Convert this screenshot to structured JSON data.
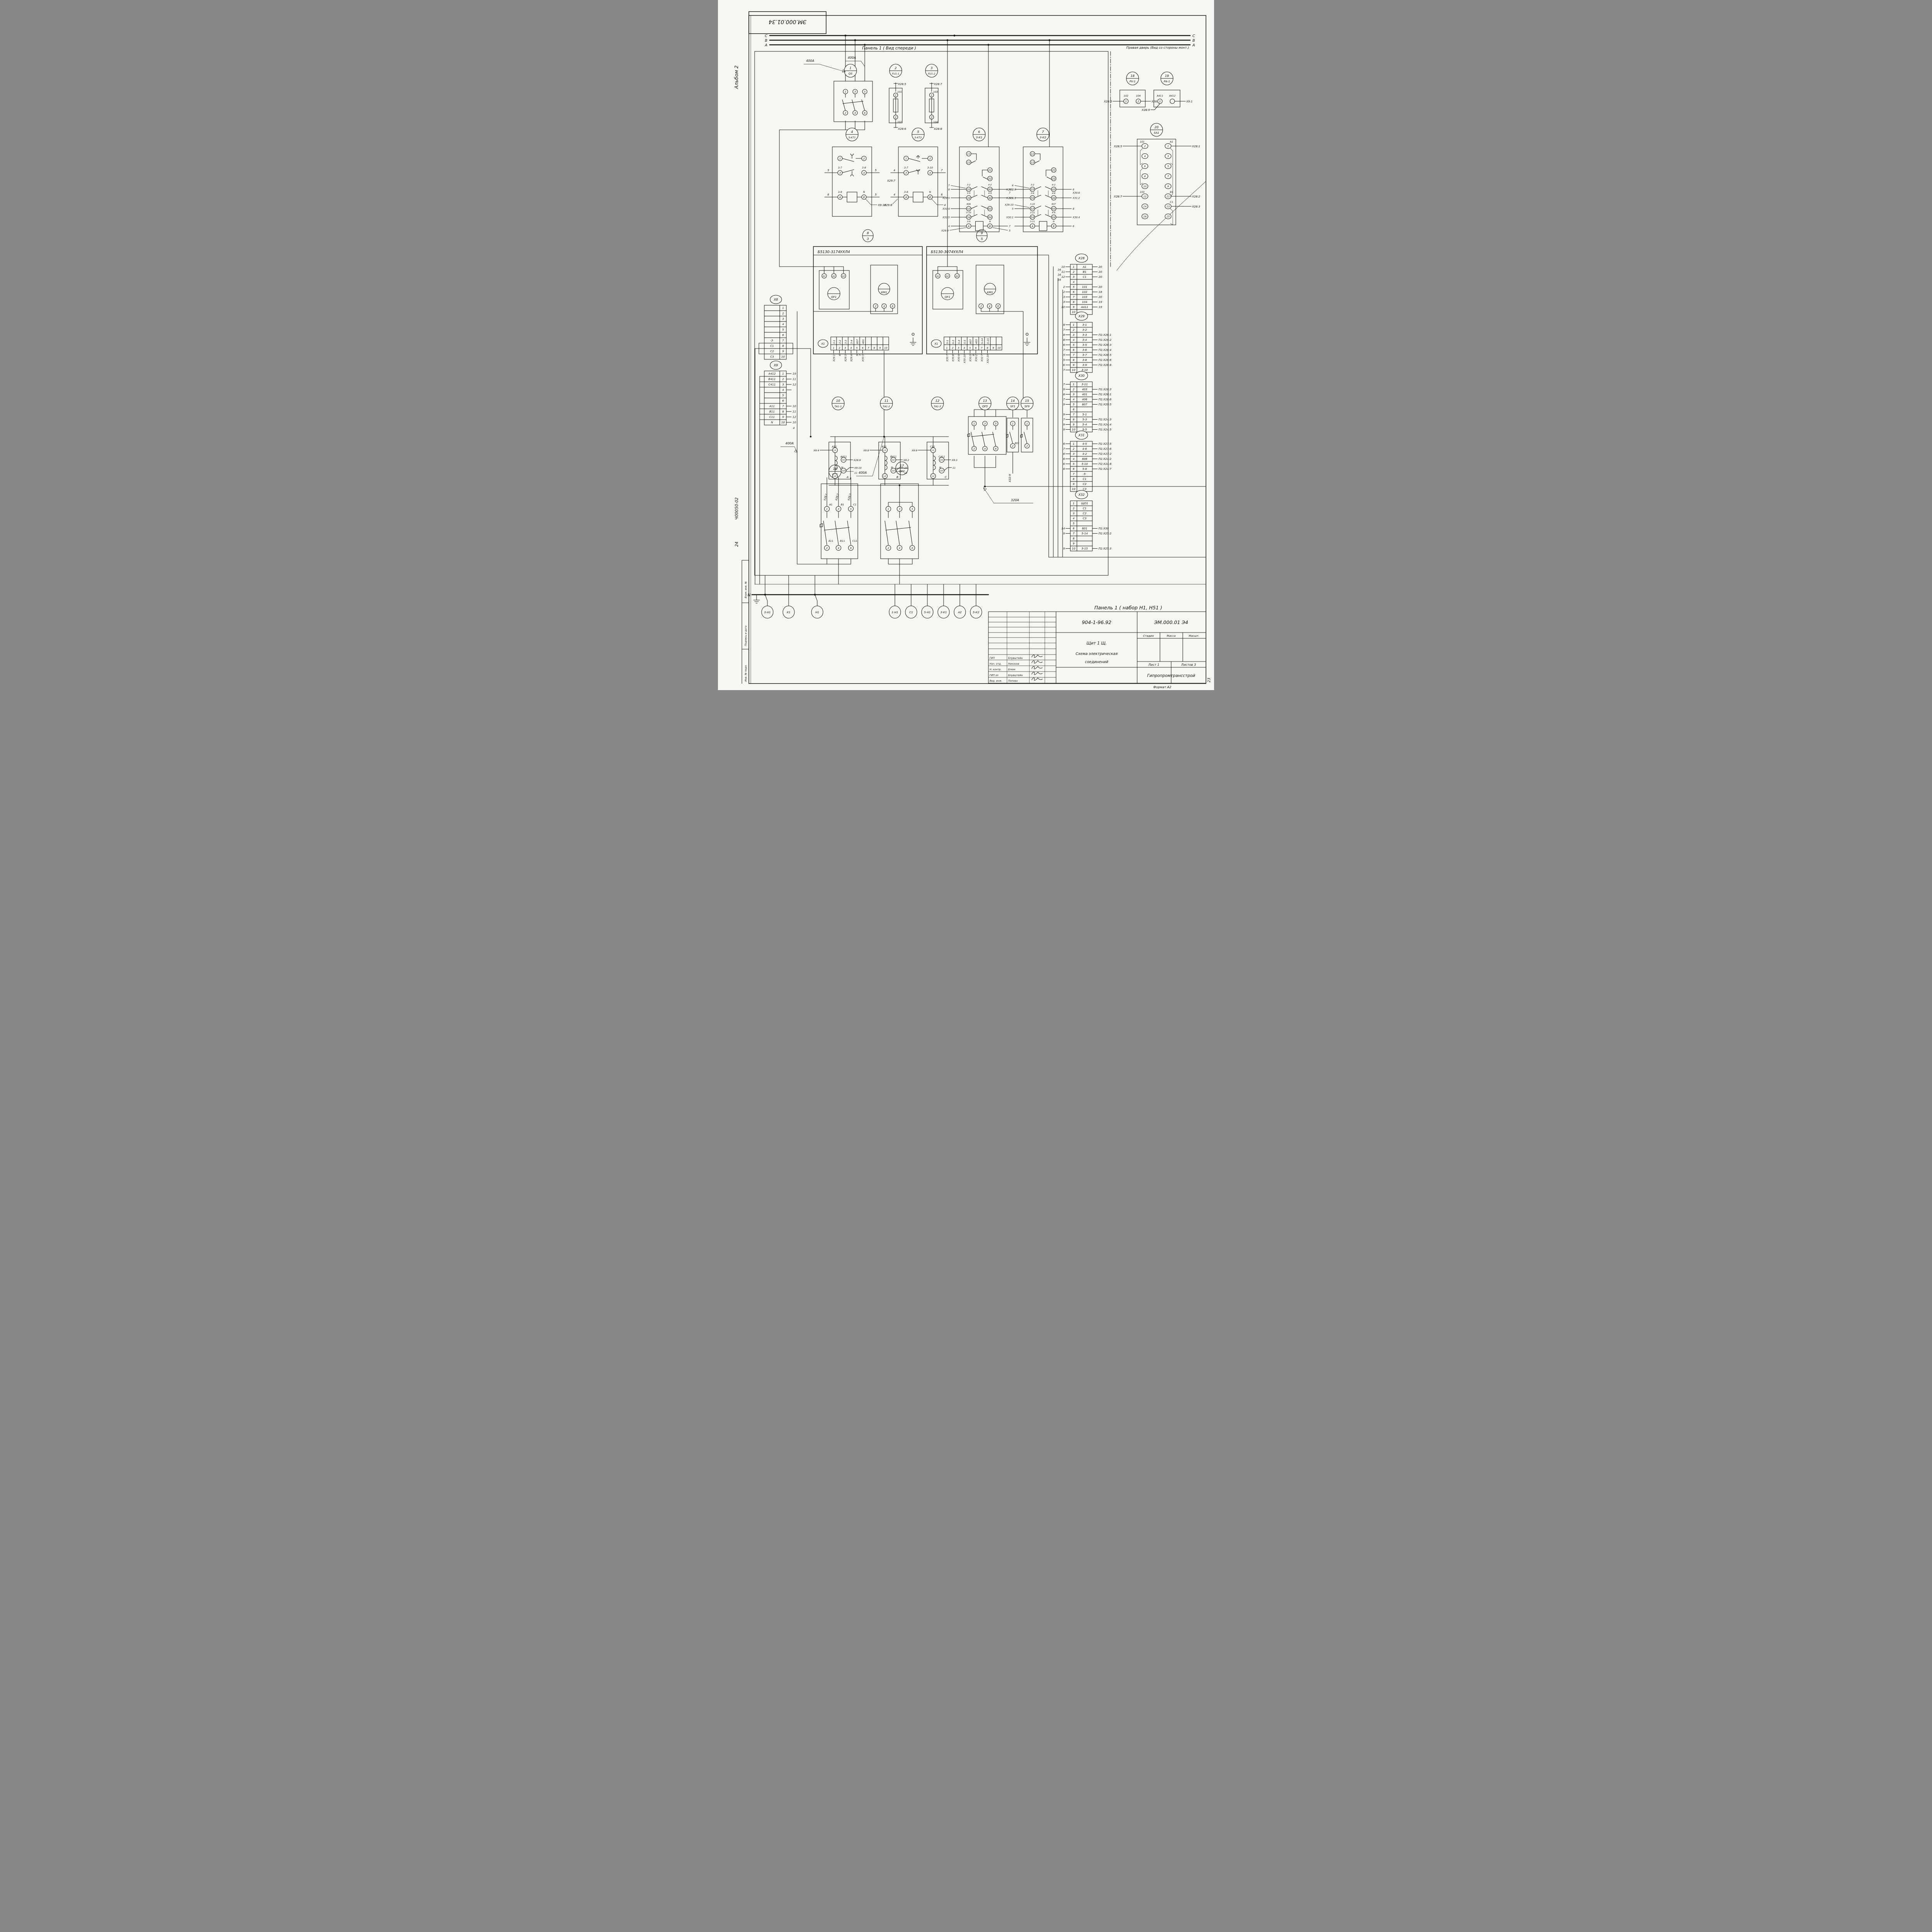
{
  "frame": {
    "stamp": "ЭМ.000.01.34",
    "album": "Альбом 2",
    "page": "23",
    "format": "Формат А2",
    "margin1": "Взам. инв. №",
    "margin2": "Подпись и дата",
    "margin3": "Инв. № подл.",
    "hand1": "Ч00050-02",
    "hand2": "24"
  },
  "buses": {
    "c": "С",
    "b": "В",
    "a": "А",
    "n": "N"
  },
  "titles": {
    "panel_front": "Панель 1 ( Вид спереди )",
    "right_door": "Правая дверь (Вид со стороны монт.)",
    "panel_set": "Панель 1  ( набор  Н1, Н51 )"
  },
  "labels": {
    "amp400": "400А",
    "amp320": "320А",
    "x9extra": "4"
  },
  "devices": {
    "d1": {
      "num": "1",
      "name": "QS",
      "t": [
        "1",
        "3",
        "5",
        "2",
        "4",
        "6"
      ]
    },
    "d2": {
      "num": "2",
      "name": "FU1-1",
      "top": "Х28:5",
      "w1": "101",
      "t1": "1",
      "t2": "2",
      "w2": "102",
      "bot": "Х28:6"
    },
    "d3": {
      "num": "3",
      "name": "FU1-2",
      "top": "Х28:7",
      "w1": "103",
      "t1": "1",
      "t2": "2",
      "w2": "104",
      "bot": "Х28:8"
    },
    "d4": {
      "num": "4",
      "name": "3-КТ1",
      "t1": "1",
      "t2": "2",
      "w3": "3-7",
      "w4": "3-8",
      "t3": "3",
      "t4": "4",
      "l3": "5",
      "r4": "5",
      "wa": "3-9",
      "wb": "N",
      "ta": "А",
      "tb": "В",
      "la": "6",
      "rb": "5",
      "anno": "Х9:10"
    },
    "d5": {
      "num": "5",
      "name": "3-КТ2",
      "t1": "1",
      "t2": "2",
      "w3": "3-7",
      "w4": "3-10",
      "t3": "3",
      "t4": "4",
      "l3": "4",
      "l3b": "Х29:7",
      "r4": "7",
      "wa": "3-8",
      "wb": "N",
      "ta": "А",
      "tb": "В",
      "la": "4",
      "lab": "Х29:8",
      "rb": "6",
      "anno": "4"
    },
    "d6": {
      "num": "6",
      "name": "3-К1",
      "t11": "11",
      "t12": "12",
      "t21": "21",
      "t22": "22",
      "rows": [
        {
          "lt": "33",
          "lw": "3-2",
          "la": "8",
          "lb": "7",
          "rt": "43",
          "rw": "4-2",
          "ra": "Х31:3",
          "rb": "7"
        },
        {
          "lt": "34",
          "lw": "3-5",
          "la": "Х29:5",
          "lb": "",
          "rt": "44",
          "rw": "4-5",
          "ra": "Х31:1",
          "rb": ""
        },
        {
          "lt": "53",
          "lw": "806",
          "la": "Х31:4",
          "lb": "",
          "rt": "63",
          "rw": "",
          "ra": "",
          "rb": ""
        },
        {
          "lt": "54",
          "lw": "5-10",
          "la": "Х31:5",
          "lb": "",
          "rt": "64",
          "rw": "",
          "ra": "",
          "rb": ""
        }
      ],
      "caw": "3-9",
      "ca": "А",
      "cal": "4",
      "cal2": "Х29:9",
      "cbw": "N",
      "cb": "В",
      "cbr": "7",
      "cbr2": "5"
    },
    "d7": {
      "num": "7",
      "name": "3-К2",
      "t11": "11",
      "t12": "12",
      "t21": "21",
      "t22": "22",
      "rows": [
        {
          "lt": "33",
          "lw": "3-2",
          "la": "Х29:2",
          "lb": "6",
          "rt": "43",
          "rw": "4-2",
          "ra": "6",
          "rb": "Х30:8"
        },
        {
          "lt": "34",
          "lw": "3-6",
          "la": "Х29:6",
          "lb": "",
          "rt": "44",
          "rw": "4-6",
          "ra": "Х31:2",
          "rb": ""
        },
        {
          "lt": "53",
          "lw": "3-10",
          "la": "5",
          "lb": "Х29:10",
          "rt": "63",
          "rw": "807",
          "ra": "8",
          "rb": ""
        },
        {
          "lt": "54",
          "lw": "3-11",
          "la": "Х30:1",
          "lb": "",
          "rt": "64",
          "rw": "4-6",
          "ra": "Х30:4",
          "rb": ""
        }
      ],
      "caw": "3-11",
      "ca": "А",
      "cal": "",
      "cal2": "",
      "cbw": "N",
      "cb": "В",
      "cbr": "6",
      "cbr2": ""
    },
    "d8": {
      "num": "8",
      "sub": "3",
      "header": "Б5130-3174УХЛ4",
      "qf": "QF1",
      "a1": "А1",
      "a2": "А2",
      "a3": "А3",
      "km": "КМ1",
      "k2": "2",
      "k4": "4",
      "k6": "6"
    },
    "d9": {
      "num": "9",
      "sub": "5",
      "header": "Б5130-3074УХЛ4",
      "qf": "QF1",
      "a1": "А1",
      "a2": "А2",
      "a3": "А3",
      "km": "КМ1",
      "k2": "2",
      "k4": "4",
      "k6": "6"
    },
    "d10": {
      "num": "10",
      "name": "ТА1-1",
      "l1": "L1",
      "u1": "U1",
      "u2": "U2",
      "l2": "L2",
      "wl1": "А11",
      "wu1": "А411",
      "wu2": "N",
      "phase": "А",
      "al1": "Х9:4",
      "au1": "Х28:9",
      "au2": "Х9:10",
      "au2b": "11"
    },
    "d11": {
      "num": "11",
      "name": "ТА1-2",
      "l1": "L1",
      "u1": "U1",
      "u2": "U2",
      "l2": "L2",
      "wl1": "В11",
      "wu1": "В411",
      "wu2": "N",
      "phase": "В",
      "al1": "Х9:8",
      "au1": "Х9:2",
      "au2": "10",
      "au2b": "12"
    },
    "d12": {
      "num": "12",
      "name": "ТА1-3",
      "l1": "L1",
      "u1": "U1",
      "u2": "U2",
      "l2": "L2",
      "wl1": "С11",
      "wu1": "С411",
      "wu2": "N",
      "phase": "С",
      "al1": "Х9:9",
      "au1": "Х9:3",
      "au2": "11",
      "au2b": ""
    },
    "d13": {
      "num": "13",
      "name": "QF5",
      "t": [
        "1",
        "3",
        "5",
        "2",
        "4",
        "6"
      ]
    },
    "d14": {
      "num": "14",
      "name": "SF1",
      "t1": "1",
      "t2": "2",
      "w": "801",
      "anno": "Х32:9"
    },
    "d15": {
      "num": "15",
      "name": "SF9",
      "t1": "1",
      "t2": "2"
    },
    "d16": {
      "num": "16",
      "name": "QF1",
      "annos": [
        "Х28:1",
        "Х28:2",
        "Х28:3"
      ],
      "topw": [
        "А1",
        "В1",
        "С1"
      ],
      "botw": [
        "А11",
        "В11",
        "С11"
      ],
      "t": [
        "1",
        "3",
        "5",
        "2",
        "4",
        "6"
      ]
    },
    "d17": {
      "num": "17",
      "name": "QF2",
      "t": [
        "1",
        "3",
        "5",
        "2",
        "4",
        "6"
      ]
    },
    "d18": {
      "num": "18",
      "name": "PV-1",
      "w1": "102",
      "w2": "104",
      "t1": "1",
      "t2": "2",
      "l": "Х28:6",
      "r": "Х28:8"
    },
    "d19": {
      "num": "19",
      "name": "PA-1",
      "w1": "А411",
      "w2": "А412",
      "t1": "1",
      "l": "Х28:9",
      "r": "Х9:1"
    },
    "d20": {
      "num": "20",
      "name": "SA1",
      "left": [
        [
          "2",
          "101"
        ],
        [
          "4",
          ""
        ],
        [
          "6",
          ""
        ],
        [
          "8",
          ""
        ],
        [
          "10",
          ""
        ],
        [
          "12",
          "103"
        ],
        [
          "14",
          ""
        ],
        [
          "16",
          ""
        ]
      ],
      "right": [
        [
          "1",
          "А1"
        ],
        [
          "3",
          ""
        ],
        [
          "5",
          ""
        ],
        [
          "7",
          ""
        ],
        [
          "9",
          ""
        ],
        [
          "11",
          "В1"
        ],
        [
          "13",
          "С1"
        ],
        [
          "15",
          ""
        ]
      ],
      "al2": "Х28:5",
      "al12": "Х28:7",
      "ar1": "Х28:1",
      "ar11": "Х28:2",
      "ar13": "Х28:3"
    }
  },
  "x1strips": {
    "x1a": {
      "tag": "Х1",
      "cells": [
        [
          "1",
          "3-1"
        ],
        [
          "2",
          "3-2"
        ],
        [
          "3",
          "3-3"
        ],
        [
          "4",
          "3-4"
        ],
        [
          "5",
          "807"
        ],
        [
          "6",
          "401"
        ],
        [
          "7",
          ""
        ],
        [
          "8",
          ""
        ],
        [
          "9",
          ""
        ],
        [
          "10",
          ""
        ]
      ],
      "annos": [
        "Х29:1",
        "6",
        "Х29:3",
        "Х29:4",
        "9 7",
        "Х30:3",
        "",
        "",
        "",
        ""
      ]
    },
    "x1b": {
      "tag": "Х1",
      "cells": [
        [
          "1",
          "5-1"
        ],
        [
          "2",
          "5-3"
        ],
        [
          "3",
          "5-4"
        ],
        [
          "4",
          "5-5"
        ],
        [
          "5",
          "807"
        ],
        [
          "6",
          "403"
        ],
        [
          "7",
          "5-14"
        ],
        [
          "8",
          "5-15"
        ],
        [
          "9",
          ""
        ],
        [
          "10",
          ""
        ]
      ],
      "annos": [
        "Х30:7",
        "Х30:8",
        "Х30:9",
        "Х30:10",
        "Х30:5 8",
        "Х30:2",
        "Х32:7",
        "Х32:10",
        "",
        ""
      ]
    }
  },
  "strips": {
    "x8": {
      "name": "Х8",
      "rows": [
        [
          "1",
          "",
          "",
          ""
        ],
        [
          "2",
          "",
          "",
          ""
        ],
        [
          "3",
          "",
          "",
          ""
        ],
        [
          "4",
          "",
          "",
          ""
        ],
        [
          "5",
          "",
          "",
          ""
        ],
        [
          "6",
          "",
          "",
          ""
        ],
        [
          "7",
          "·3·",
          "",
          ""
        ],
        [
          "8",
          "С1",
          "",
          ""
        ],
        [
          "9",
          "С2",
          "",
          ""
        ],
        [
          "10",
          "С3",
          "",
          ""
        ]
      ]
    },
    "x9": {
      "name": "Х9",
      "rows": [
        [
          "1",
          "А412",
          "",
          "19"
        ],
        [
          "2",
          "В411",
          "",
          "11"
        ],
        [
          "3",
          "С411",
          "",
          "12"
        ],
        [
          "4",
          "",
          "",
          ""
        ],
        [
          "5",
          "",
          "",
          ""
        ],
        [
          "6",
          "",
          "",
          ""
        ],
        [
          "7",
          "А11",
          "",
          "10"
        ],
        [
          "8",
          "В11",
          "",
          "11"
        ],
        [
          "9",
          "С11",
          "",
          "12"
        ],
        [
          "10",
          "N",
          "",
          "10"
        ]
      ]
    },
    "x28": {
      "name": "Х28",
      "rows": [
        [
          "1",
          "А1",
          "10 16",
          "20"
        ],
        [
          "2",
          "В1",
          "11 16",
          "20"
        ],
        [
          "3",
          "С1",
          "12 16",
          "20"
        ],
        [
          "4",
          "",
          "",
          ""
        ],
        [
          "5",
          "101",
          "2",
          "20"
        ],
        [
          "6",
          "102",
          "2",
          "18"
        ],
        [
          "7",
          "103",
          "3",
          "20"
        ],
        [
          "8",
          "104",
          "3",
          "19"
        ],
        [
          "9",
          "А411",
          "10",
          "19"
        ],
        [
          "10",
          "",
          "",
          ""
        ]
      ]
    },
    "x29": {
      "name": "Х29",
      "rows": [
        [
          "1",
          "3-1",
          "8",
          ""
        ],
        [
          "2",
          "3-2",
          "7",
          ""
        ],
        [
          "3",
          "3-3",
          "8",
          "П2.Х26:1"
        ],
        [
          "4",
          "3-4",
          "8",
          "П2.Х26:2"
        ],
        [
          "5",
          "3-5",
          "6",
          "П2.Х26:3"
        ],
        [
          "6",
          "3-6",
          "7",
          "П2.Х26:4"
        ],
        [
          "7",
          "3-7",
          "5",
          "П2.Х26:5"
        ],
        [
          "8",
          "3-8",
          "5",
          "П2.Х26:6"
        ],
        [
          "9",
          "3-9",
          "6",
          "П2.Х26:8"
        ],
        [
          "10",
          "3-10",
          "7",
          ""
        ]
      ]
    },
    "x30": {
      "name": "Х30",
      "rows": [
        [
          "1",
          "3-11",
          "7",
          ""
        ],
        [
          "2",
          "403",
          "9",
          "П2.Х28:3"
        ],
        [
          "3",
          "401",
          "8",
          "П2.Х28:1"
        ],
        [
          "4",
          "406",
          "7",
          "П2.Х28:6"
        ],
        [
          "5",
          "807",
          "9",
          "П2.Х29:5"
        ],
        [
          "6",
          "",
          "",
          ""
        ],
        [
          "7",
          "5-1",
          "9",
          ""
        ],
        [
          "8",
          "5-3",
          "7",
          "П2.Х24:3"
        ],
        [
          "9",
          "5-4",
          "9",
          "П2.Х24:4"
        ],
        [
          "10",
          "5-5",
          "9",
          "П2.Х24:5"
        ]
      ]
    },
    "x31": {
      "name": "Х31",
      "rows": [
        [
          "1",
          "4-5",
          "6",
          "П2.Х27:5"
        ],
        [
          "2",
          "4-6",
          "7",
          "П2.Х27:6"
        ],
        [
          "3",
          "4-2",
          "6",
          "П2:Х27:2"
        ],
        [
          "4",
          "806",
          "6",
          "П2.Х24:2"
        ],
        [
          "5",
          "5-10",
          "6",
          "П2:Х24:8"
        ],
        [
          "6",
          "5-8",
          "6",
          "П2.Х24:7"
        ],
        [
          "7",
          "·5·",
          "",
          ""
        ],
        [
          "8",
          "С1",
          "",
          ""
        ],
        [
          "9",
          "С2",
          "",
          ""
        ],
        [
          "10",
          "С3",
          "",
          ""
        ]
      ]
    },
    "x32": {
      "name": "Х32",
      "rows": [
        [
          "1",
          "ЩО1",
          "",
          ""
        ],
        [
          "2",
          "С1",
          "",
          ""
        ],
        [
          "3",
          "С2",
          "",
          ""
        ],
        [
          "4",
          "С3",
          "",
          ""
        ],
        [
          "5",
          "",
          "",
          ""
        ],
        [
          "6",
          "801",
          "14",
          "П2.Х30"
        ],
        [
          "7",
          "5-14",
          "9",
          "П2.Х25:2"
        ],
        [
          "8",
          "",
          "",
          ""
        ],
        [
          "9",
          "",
          "",
          ""
        ],
        [
          "10",
          "5-15",
          "9",
          "П2.Х25:3"
        ]
      ]
    }
  },
  "terminals_bottom": {
    "left": [
      "3-Н1",
      "К1",
      "Н1"
    ],
    "right": [
      "1-Н1",
      "С1",
      "5-Н1",
      "3-К1",
      "А2",
      "5-К2"
    ]
  },
  "titleblock": {
    "doc_no": "904-1-96.92",
    "code": "ЭМ.000.01  Э4",
    "object": "Щит 1 Щ.",
    "t1": "Схема электрическая",
    "t2": "соединений",
    "stage_h": "Стадия",
    "mass_h": "Масса",
    "scale_h": "Масшт.",
    "sheet": "Лист 1",
    "sheets": "Листов  3",
    "org": "Гипропромтрансстрой",
    "roles": [
      [
        "ГИП",
        "Блувштейн"
      ],
      [
        "Нач. отд.",
        "Никонов"
      ],
      [
        "Н. контр.",
        "Блюм"
      ],
      [
        "ГИП эл",
        "Блувштейн"
      ],
      [
        "Вед. инж.",
        "Попова"
      ]
    ]
  }
}
